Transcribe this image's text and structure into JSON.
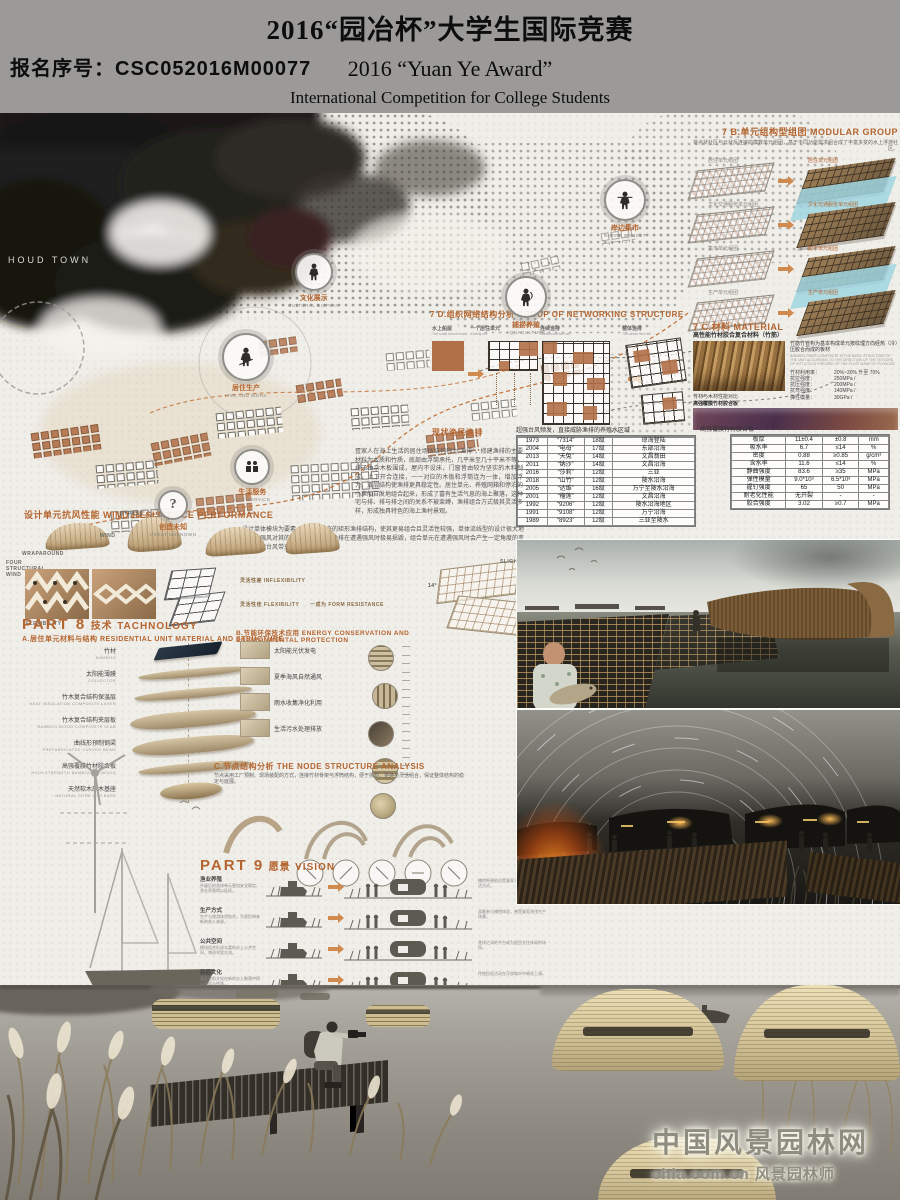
{
  "header": {
    "title": "2016“园冶杯”大学生国际竞赛",
    "registration": "报名序号：CSC052016M00077",
    "subtitle_en": "2016 “Yuan Ye Award”",
    "subtitle_line2": "International Competition for College Students"
  },
  "colors": {
    "accent": "#b4652f",
    "terracotta": "#b16f47",
    "cyan_water": "#9fd6e2",
    "header_gray": "#9b9a98"
  },
  "map": {
    "town_label": "HOUD TOWN",
    "markers": [
      {
        "cn": "文化展示",
        "en": "CULTURAL DISPLAY",
        "glyph": ""
      },
      {
        "cn": "居住生产",
        "en": "LIVE AND WORK",
        "glyph": ""
      },
      {
        "cn": "捕捞养殖",
        "en": "AQUACULTURE",
        "glyph": ""
      },
      {
        "cn": "岸边集市",
        "en": "SHORE MARKET",
        "glyph": ""
      },
      {
        "cn": "生活服务",
        "en": "LIFE SERVICE",
        "glyph": ""
      },
      {
        "cn": "创造未知",
        "en": "CREAT UNKNOWN",
        "glyph": "?"
      }
    ]
  },
  "section_7b": {
    "title": "7 B.单元组构型组团 MODULAR GROUP",
    "desc": "将点状社区与云状反连接的模数单元组团，基于不同功能需求组合成了丰富多变的水上浮游社区。",
    "rows": [
      {
        "left": "居住单元组团",
        "right": "居住单元组团",
        "_class": "water"
      },
      {
        "left": "文化交通服务单元组团",
        "right": "文化交通服务单元组团",
        "_class": ""
      },
      {
        "left": "集市单元组团",
        "right": "集市单元组团",
        "_class": "water"
      },
      {
        "left": "生产单元组团",
        "right": "生产单元组团",
        "_class": ""
      }
    ]
  },
  "section_7c": {
    "title": "7 C.材料 MATERIAL",
    "sub": "高性能竹材胶合复合材料（竹筋）",
    "desc_cn": "竹筋竹管构为基本构成单元按纹理方向经热（冷）压胶合而成的板材",
    "desc_en": "BAMBOO FIBER COMPOSITE IS THE BASIC STRUCTURE OF THE UNIT ACCORDING TO THE DIRECTION OF THE TEXTURE OF HOT (COLD) PRESSED OF THE PLATE MADE OF PLYWOOD",
    "props": [
      {
        "k": "竹材利用率：",
        "v": "20%~30% 升至 70%"
      },
      {
        "k": "抗拉强度：",
        "v": "250MPa /"
      },
      {
        "k": "抗压强度：",
        "v": "200MPa /"
      },
      {
        "k": "抗弯强度：",
        "v": "140MPa /"
      },
      {
        "k": "弹性模量：",
        "v": "30GPa /"
      }
    ],
    "note": "竹材与木材性能对比",
    "board_label": "高强覆膜竹材胶合板"
  },
  "material_table": {
    "title": "高强覆膜竹材胶合板",
    "headers": [
      "性能指标",
      "高强覆膜竹材胶合板",
      "标准规定值（一等品）",
      "单位"
    ],
    "rows": [
      [
        "板厚",
        "11±0.4",
        "±0.8",
        "mm"
      ],
      [
        "吸水率",
        "6.7",
        "≤14",
        "%"
      ],
      [
        "密度",
        "0.88",
        "≥0.85",
        "g/cm³"
      ],
      [
        "含水率",
        "11.6",
        "≤14",
        "%"
      ],
      [
        "静曲强度",
        "83.6",
        "≥35",
        "MPa"
      ],
      [
        "弹性模量",
        "9.0*10³",
        "6.5*10³",
        "MPa"
      ],
      [
        "握钉强度",
        "65",
        "50",
        "MPa"
      ],
      [
        "耐老化性能",
        "无开裂",
        "-",
        "-"
      ],
      [
        "胶合强度",
        "3.02",
        "≥0.7",
        "MPa"
      ]
    ]
  },
  "typhoon_table": {
    "title": "超强台风频发，直接威胁渔排的养殖水区域",
    "headers": [
      "年份",
      "台风名称",
      "最大风力",
      "登陆地点"
    ],
    "rows": [
      [
        "1973",
        "“7314”",
        "18级",
        "琼海登陆"
      ],
      [
        "2004",
        "“电母”",
        "17级",
        "东部沿海"
      ],
      [
        "2013",
        "“天兔”",
        "14级",
        "文昌翁田"
      ],
      [
        "2011",
        "“纳沙”",
        "14级",
        "文昌沿海"
      ],
      [
        "2016",
        "“莎莉”",
        "12级",
        "三亚"
      ],
      [
        "2018",
        "“山竹”",
        "12级",
        "陵水沿海"
      ],
      [
        "2005",
        "“达维”",
        "16级",
        "万宁至陵水沿海"
      ],
      [
        "2001",
        "“榴莲”",
        "12级",
        "文昌沿海"
      ],
      [
        "1992",
        "“9206”",
        "12级",
        "陵水沿海地区"
      ],
      [
        "1991",
        "“9108”",
        "12级",
        "万宁沿海"
      ],
      [
        "1989",
        "“8923”",
        "12级",
        "三亚至陵水"
      ]
    ]
  },
  "section_7d": {
    "title": "7 D.组织网络结构分析  GROUP OF NETWORKING STRUCTURE",
    "items": [
      {
        "cn": "水上船屋",
        "en": "The small house boats"
      },
      {
        "cn": "一个居住单元",
        "en": "A living cell"
      },
      {
        "cn": "连续渔排",
        "en": "Continuous fish raft"
      },
      {
        "cn": "整体渔排",
        "en": "The whole fish raft"
      }
    ],
    "legend": [
      "养殖区域",
      "居住区",
      "小渔船"
    ],
    "caption": "现状渔民渔排"
  },
  "paragraphs": {
    "dan_family": "疍家人在海上生活的居住场所结构称为“渔排”，修建渔排的主要材料为木质和竹质，底部由浮筒承托，几平米至几十平米不等，排子由杂木板围成，屋内不设床，门窗皆由较为坚实的木料制成，上下开合连接，一一对应的木板和浮筒连为一体，增加浮力，双层结构使渔排更具稳定性。居住单元、养殖网箱和停泊的小渔船自发地组合起来，形成了富有生活气息的海上聚落，这种宅与排、排与排之间的关系不被束缚，渔排组合方式极其灵活多样，形成独具特色的海上渔村景观。",
    "module_design": "设计单体模块为要素，改变了原来的矩形渔排结构，使其更易组合且灵活性较强，单体流线型的设计很大地削弱了强风对其的破坏性；原本的渔排在遭遇强风时极易损毁，组合单元在遭遇强风时会产生一定角度的变形，分散台风带来的冲击力。"
  },
  "wind": {
    "title": "设计单元抗风性能  WIND RESISTANCE PERFORMANCE",
    "labels": {
      "wraparound": "WRAPAROUND",
      "bypass": "BYPASS",
      "wind": "WIND",
      "four": "FOUR STRUCTURAL WIND",
      "flex_photo": "FLEXIBILITY",
      "inflexible": "灵活性差  INFLEXIBILITY",
      "flexible": "灵活性佳  FLEXIBILITY",
      "form": "一成为  FORM RESISTANCE",
      "movement": "SLIGHT MOVEMENT",
      "angle": "14°"
    }
  },
  "part8": {
    "title_code": "PART 8",
    "title_cn": "技术",
    "title_en": "TACHNOLOGY",
    "a_title": "A.居住单元材料与结构 RESIDENTIAL UNIT MATERIAL AND STRUCTURE",
    "left_labels": [
      {
        "cn": "竹材",
        "en": "BAMBOO"
      },
      {
        "cn": "太阳能薄膜",
        "en": "COLLECTOR"
      },
      {
        "cn": "竹木复合结构保温层",
        "en": "HEAT INSULATION COMPOSITE LAYER"
      },
      {
        "cn": "竹木复合结构夹层板",
        "en": "BAMBOO-WOOD COMPOSITE SLAB"
      },
      {
        "cn": "曲线形预制钢梁",
        "en": "PREFABRICATED CURVED BEAM"
      },
      {
        "cn": "高强覆膜竹材胶合板",
        "en": "HIGH-STRENGTH BAMBOO PLYWOOD"
      },
      {
        "cn": "天然软木原木基座",
        "en": "NATURAL CORK LOG BASE"
      }
    ],
    "right_labels": [
      "玻璃幕墙",
      "二氧化硅",
      "太阳能",
      "氟聚合物",
      "银",
      "EVA胶粘剂",
      "玻璃基板",
      "竹材粘合板",
      "3层沥青防水膜",
      "楼面板、钢化铝",
      "防潮层、超薄防水膜",
      "木梁柱",
      "集成竹材",
      "弯曲竹材",
      "预加工",
      "胶合工艺"
    ],
    "b_title": "B.节能环保技术应用 ENERGY CONSERVATION AND ENVIRONMENTAL PROTECTION",
    "b_items": [
      {
        "label": "太阳能光伏发电"
      },
      {
        "label": "夏季海风自然通风"
      },
      {
        "label": "雨水收集净化利用"
      },
      {
        "label": "生活污水处理排放"
      }
    ],
    "c_title": "C 节点结构分析 THE NODE STRUCTURE ANALYSIS",
    "c_desc": "节点采用工厂预制、现场装配的方式，连接竹材骨架与浮筒结构，便于拆卸、更换与灵活组合，保证整体结构的稳定与延展。"
  },
  "part9": {
    "title_code": "PART 9",
    "title_cn": "愿景",
    "title_en": "VISION",
    "rows": [
      {
        "label": "渔业养殖",
        "desc": "升级后的渔排单元更加安全稳定，渔业养殖得以延续。",
        "desc2": "捕捞养殖依旧是疍家人最主要的生产生活方式。"
      },
      {
        "label": "生产方式",
        "desc": "生产与旅游体验结合，为渔民带来新的收入来源。",
        "desc2": "游客参与捕捞体验，感受疍家渔排生产场景。"
      },
      {
        "label": "公共空间",
        "desc": "模块组合形成丰富的水上公共空间，增进邻里交流。",
        "desc2": "渔排之间的平台成为居民交往休闲的场所。"
      },
      {
        "label": "民俗文化",
        "desc": "疍家民俗文化在新的水上聚落中得以延续与传承。",
        "desc2": "传统民俗活动在浮游城市中继续上演。"
      }
    ]
  },
  "closing": {
    "lines": [
      "世世水为乡，代代舟为家；沉浮江海里，世代海江南、生活随着潮汐变化而变化，疍家人的生活是浪漫的，也是清苦的，无论何种",
      "因素对疍家文化造成的冲击，都改变不了疍家人对海的念念不忘，一种建筑模块，一个想法，一份感同身受的心，",
      "让这漂泊的文化有一个容身之所，无论是生活、经济、休闲、民俗都更加受到保护，",
      "在这浮游城市之上，继续耕耘这水上田园...."
    ]
  },
  "watermark": {
    "line1": "中国风景园林网",
    "line2": "chla.com.cn 风景园林师"
  }
}
